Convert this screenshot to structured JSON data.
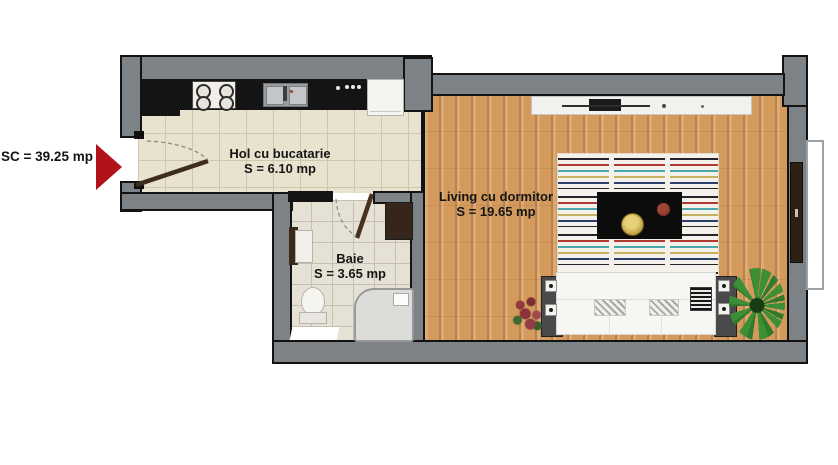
{
  "plan": {
    "title": "Apartment floor plan",
    "total_label": "SC = 39.25 mp",
    "rooms": [
      {
        "id": "hall",
        "name": "Hol cu bucatarie",
        "area": "S = 6.10 mp"
      },
      {
        "id": "bath",
        "name": "Baie",
        "area": "S = 3.65 mp"
      },
      {
        "id": "living",
        "name": "Living cu dormitor",
        "area": "S = 19.65 mp"
      }
    ],
    "colors": {
      "wall_gray": "#7d8286",
      "kitchen_counter_black": "#141414",
      "hall_tile": "#e8e2cf",
      "bath_tile": "#e5e1d5",
      "wood_floor": "#d49a5c",
      "entry_arrow_red": "#b0121a",
      "door_brown": "#46321f",
      "rug_red": "#b23a35",
      "rug_teal": "#4aa8ad",
      "plant_green": "#3c8f35"
    }
  }
}
